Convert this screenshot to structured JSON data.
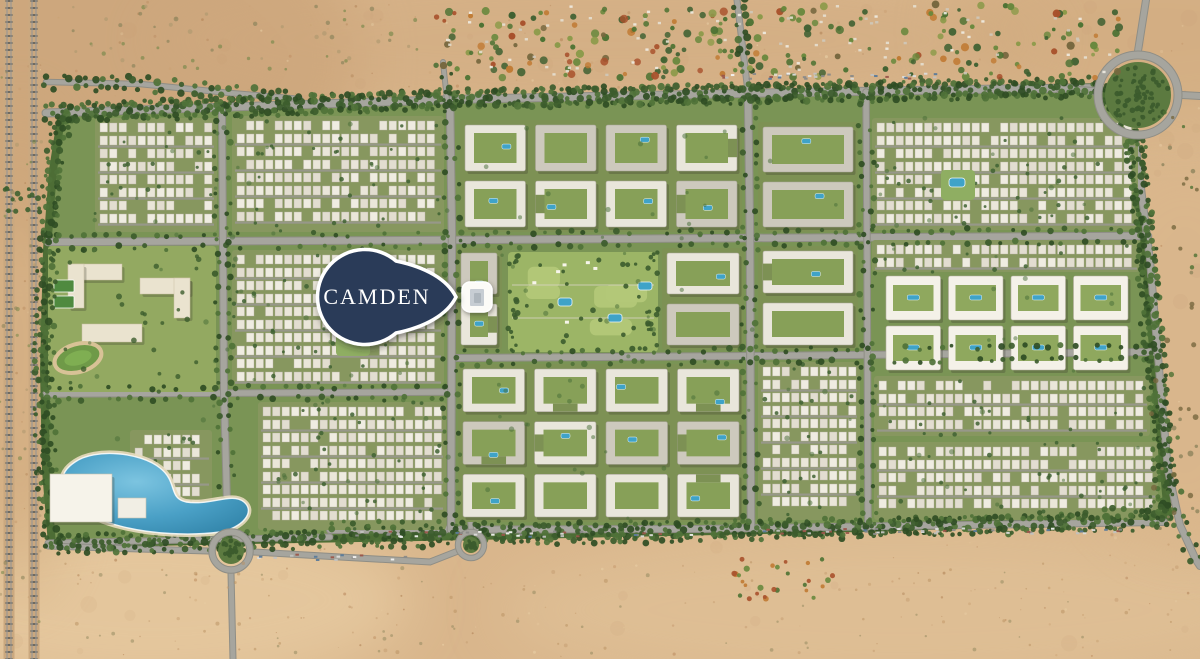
{
  "map": {
    "pin": {
      "label": "CAMDEN"
    },
    "highlight": {
      "name": "camden-building"
    },
    "features": [
      "desert-background",
      "railway-tracks",
      "development-area",
      "road-network",
      "central-park",
      "lagoon",
      "roundabout-northeast",
      "roundabout-southwest",
      "roundabout-south",
      "camden-pin",
      "camden-building-highlight"
    ],
    "colors": {
      "sand": "#d9b68c",
      "sand_dark": "#c59c72",
      "sand_light": "#e9cfa5",
      "dev_green": "#7a9455",
      "edge_green": "#4d6d35",
      "tree": "#3c5c2d",
      "lawn": "#b3c878",
      "park": "#9cb566",
      "road": "#a6a59e",
      "road_edge": "#8f8e86",
      "building": "#e9e6db",
      "building_gray": "#cdc9bd",
      "building_white": "#f4f1e8",
      "campus": "#eae3cf",
      "court": "#4f8a3f",
      "pool": "#3fa3c8",
      "lake": "#4aa0c6",
      "lake_deep": "#3588ad",
      "rail": "#6f6a60",
      "pin_fill": "#2b3b58",
      "pin_border": "#ffffff",
      "pin_text": "#ffffff",
      "highlight_fill": "#fcfbf7"
    }
  }
}
